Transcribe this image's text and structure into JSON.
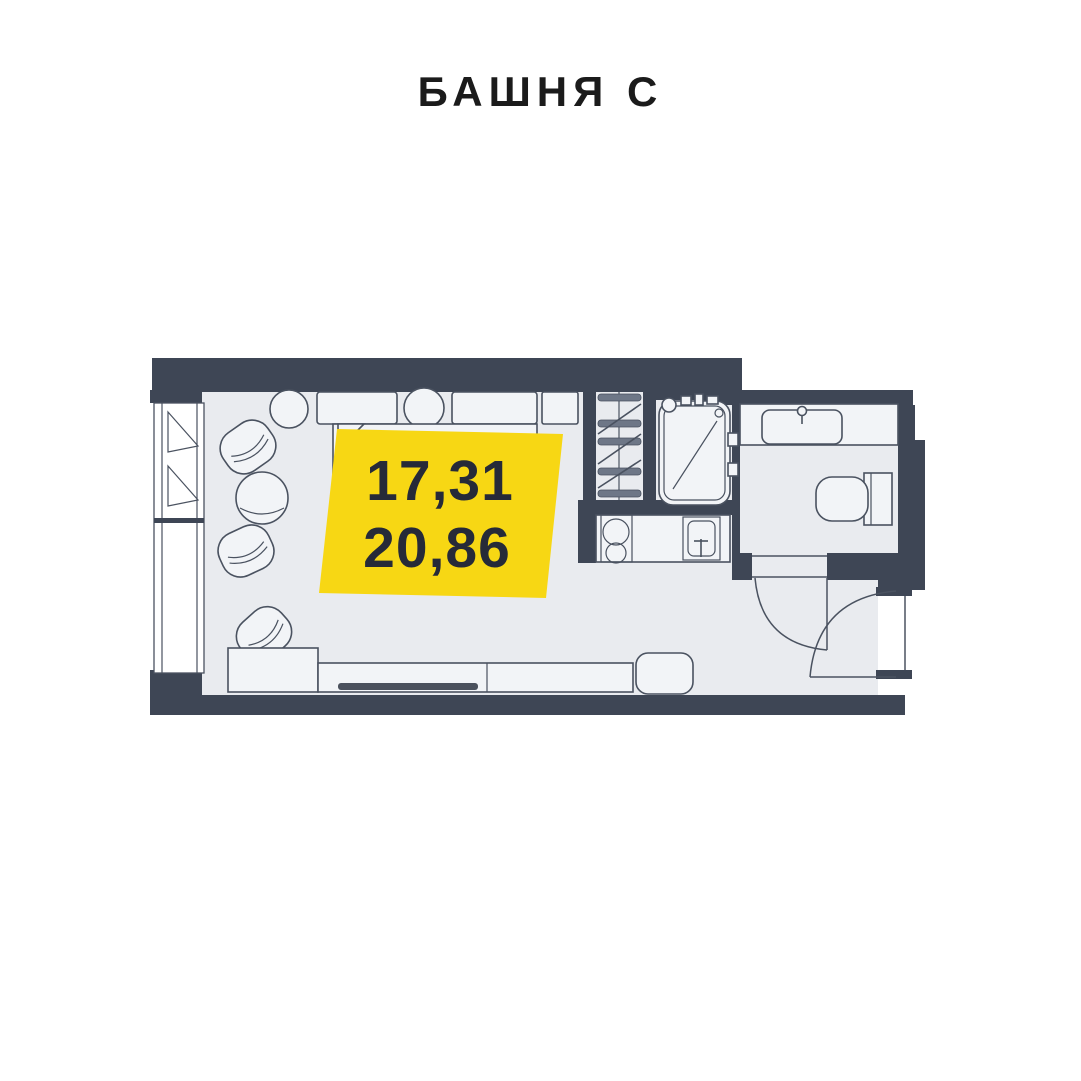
{
  "header": {
    "title": "БАШНЯ С"
  },
  "badge": {
    "line1": "17,31",
    "line2": "20,86"
  },
  "colors": {
    "background": "#FFFFFF",
    "title_text": "#1B1B1B",
    "wall": "#3E4655",
    "floor": "#E9EBEF",
    "furniture_fill": "#F2F4F7",
    "stroke": "#4A5260",
    "hatch_bar": "#6E7787",
    "tv": "#4B515D",
    "badge_bg": "#F7D714",
    "badge_text": "#262A38"
  }
}
